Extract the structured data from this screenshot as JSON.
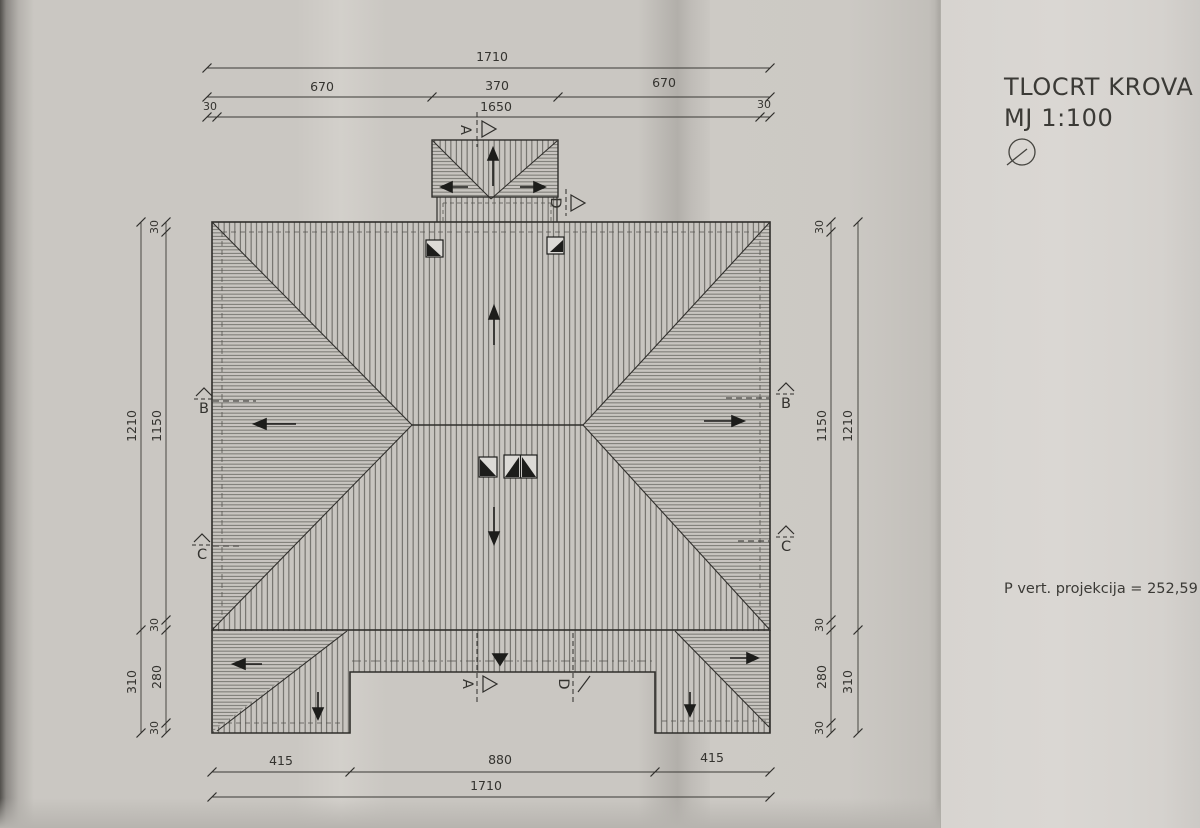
{
  "page": {
    "title": "TLOCRT KROVA",
    "scale": "MJ 1:100",
    "area_note": "P vert. projekcija = 252,59 m"
  },
  "dims": {
    "top_total": "1710",
    "top_segments": [
      "670",
      "370",
      "670"
    ],
    "top_inner": [
      "30",
      "1650",
      "30"
    ],
    "bottom_segments": [
      "415",
      "880",
      "415"
    ],
    "bottom_total": "1710",
    "left": {
      "edge_top": "30",
      "overall": "1210",
      "inner": "1150",
      "edge_mid": "30",
      "lower_overall": "310",
      "lower_inner": "280",
      "edge_bottom": "30"
    },
    "right": {
      "edge_top": "30",
      "overall": "1210",
      "inner": "1150",
      "edge_mid": "30",
      "lower_overall": "310",
      "lower_inner": "280",
      "edge_bottom": "30"
    }
  },
  "sections": {
    "a": "A",
    "b": "B",
    "c": "C",
    "d": "D"
  }
}
